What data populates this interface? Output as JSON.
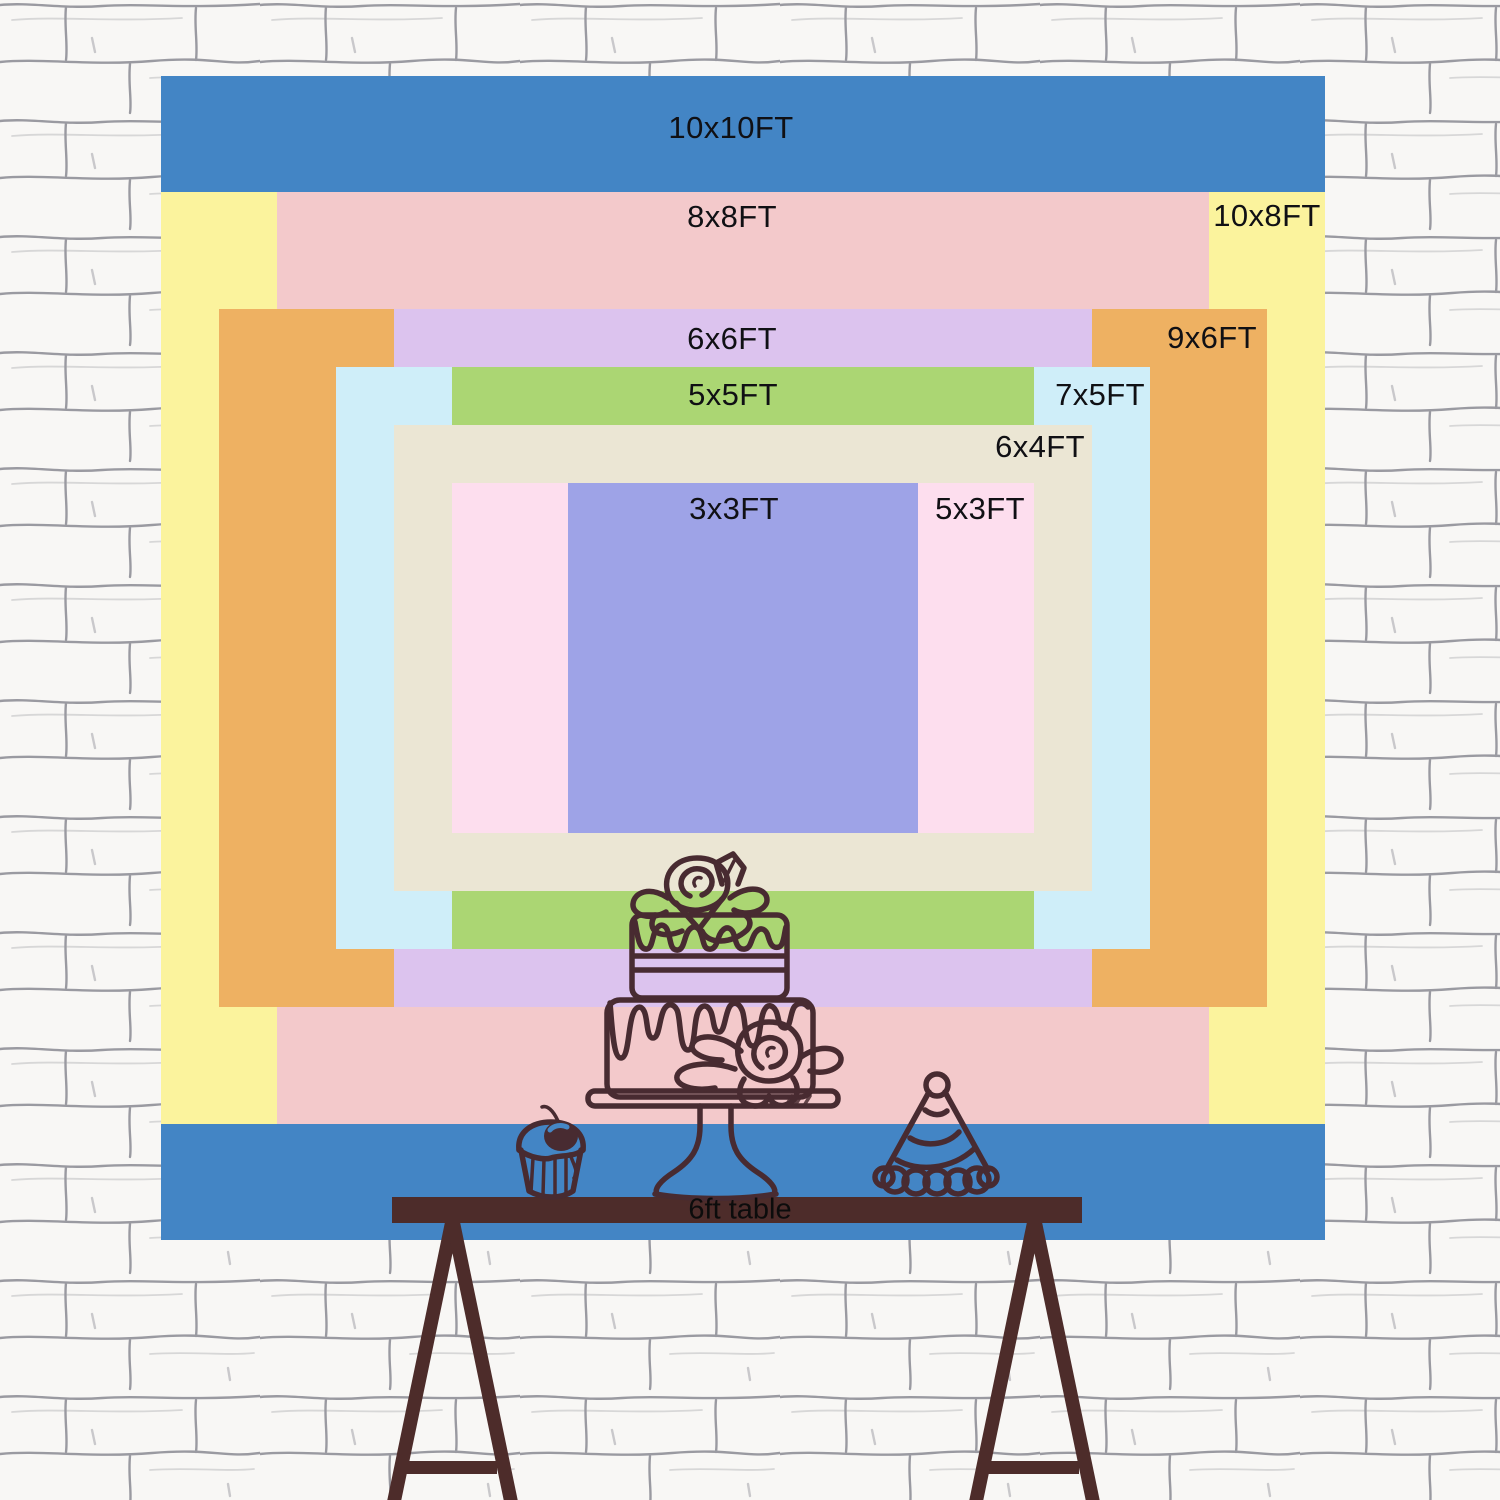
{
  "meta": {
    "description": "Backdrop size comparison chart on a white brick wall with a 6ft table, cake, cupcake and party hat line art",
    "canvas": {
      "width": 1500,
      "height": 1500
    }
  },
  "palette": {
    "line_art": "#482b31",
    "table_brown": "#4d2c2a",
    "label_text": "#101014",
    "table_text": "#0c0c0c",
    "wall_bg": "#f8f7f5",
    "wall_line": "#9a9aa1",
    "cherry_highlight": "#4587c6"
  },
  "diagram": {
    "px_per_ft": 116.4,
    "center": {
      "x": 743,
      "y": 658
    },
    "sizes": [
      {
        "label": "10x10FT",
        "w_ft": 10,
        "h_ft": 10,
        "color": "#4385c5",
        "label_x": 731,
        "label_y": 128
      },
      {
        "label": "10x8FT",
        "w_ft": 10,
        "h_ft": 8,
        "color": "#fbf39d",
        "label_x": 1267,
        "label_y": 216
      },
      {
        "label": "8x8FT",
        "w_ft": 8,
        "h_ft": 8,
        "color": "#f3c9cb",
        "label_x": 732,
        "label_y": 217
      },
      {
        "label": "9x6FT",
        "w_ft": 9,
        "h_ft": 6,
        "color": "#eeb162",
        "label_x": 1212,
        "label_y": 338
      },
      {
        "label": "6x6FT",
        "w_ft": 6,
        "h_ft": 6,
        "color": "#dcc3ee",
        "label_x": 732,
        "label_y": 339
      },
      {
        "label": "7x5FT",
        "w_ft": 7,
        "h_ft": 5,
        "color": "#cfeef9",
        "label_x": 1100,
        "label_y": 395
      },
      {
        "label": "5x5FT",
        "w_ft": 5,
        "h_ft": 5,
        "color": "#abd673",
        "label_x": 733,
        "label_y": 395
      },
      {
        "label": "6x4FT",
        "w_ft": 6,
        "h_ft": 4,
        "color": "#ebe6d4",
        "label_x": 1040,
        "label_y": 447
      },
      {
        "label": "5x3FT",
        "w_ft": 5,
        "h_ft": 3,
        "color": "#fddeee",
        "label_x": 980,
        "label_y": 509
      },
      {
        "label": "3x3FT",
        "w_ft": 3,
        "h_ft": 3,
        "color": "#9ea3e7",
        "label_x": 734,
        "label_y": 509
      }
    ],
    "table": {
      "label": "6ft table",
      "label_x": 740,
      "label_y": 1210
    }
  }
}
